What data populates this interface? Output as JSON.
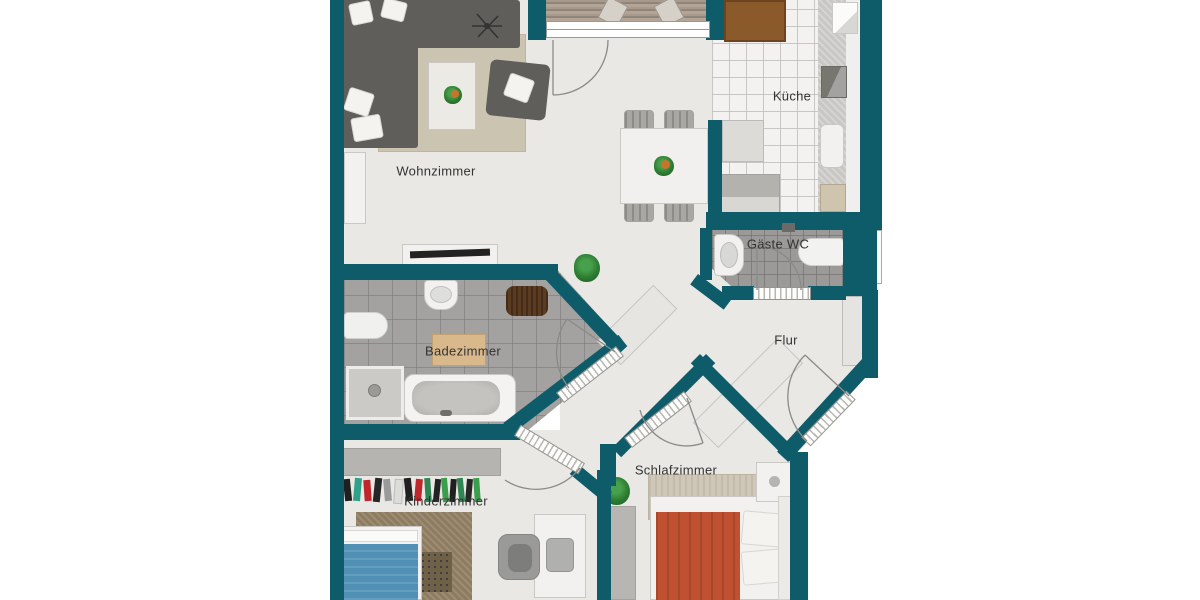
{
  "plan": {
    "type": "apartment-floor-plan",
    "language": "de"
  },
  "rooms": {
    "wohnzimmer": {
      "label": "Wohnzimmer"
    },
    "kueche": {
      "label": "Küche"
    },
    "gaeste_wc": {
      "label": "Gäste WC"
    },
    "flur": {
      "label": "Flur"
    },
    "badezimmer": {
      "label": "Badezimmer"
    },
    "kinderzimmer": {
      "label": "Kinderzimmer"
    },
    "schlafzimmer": {
      "label": "Schlafzimmer"
    }
  },
  "colors": {
    "wall": "#0e5c6a",
    "floor_light": "#e9e8e5",
    "bath_tile": "#a4a2a0",
    "wc_tile": "#9c9a98",
    "kitchen_tile": "#f3f2f0",
    "sofa_grey": "#5f5e5a",
    "rug_beige": "#cbc4b1",
    "bed_orange": "#bf5130",
    "kid_bed_blue": "#5190b5",
    "kid_rug_brown": "#8d7c60",
    "wood_table_brown": "#8a5a2b",
    "door_arc_grey": "#8a8a8a",
    "label_text": "#333333"
  }
}
